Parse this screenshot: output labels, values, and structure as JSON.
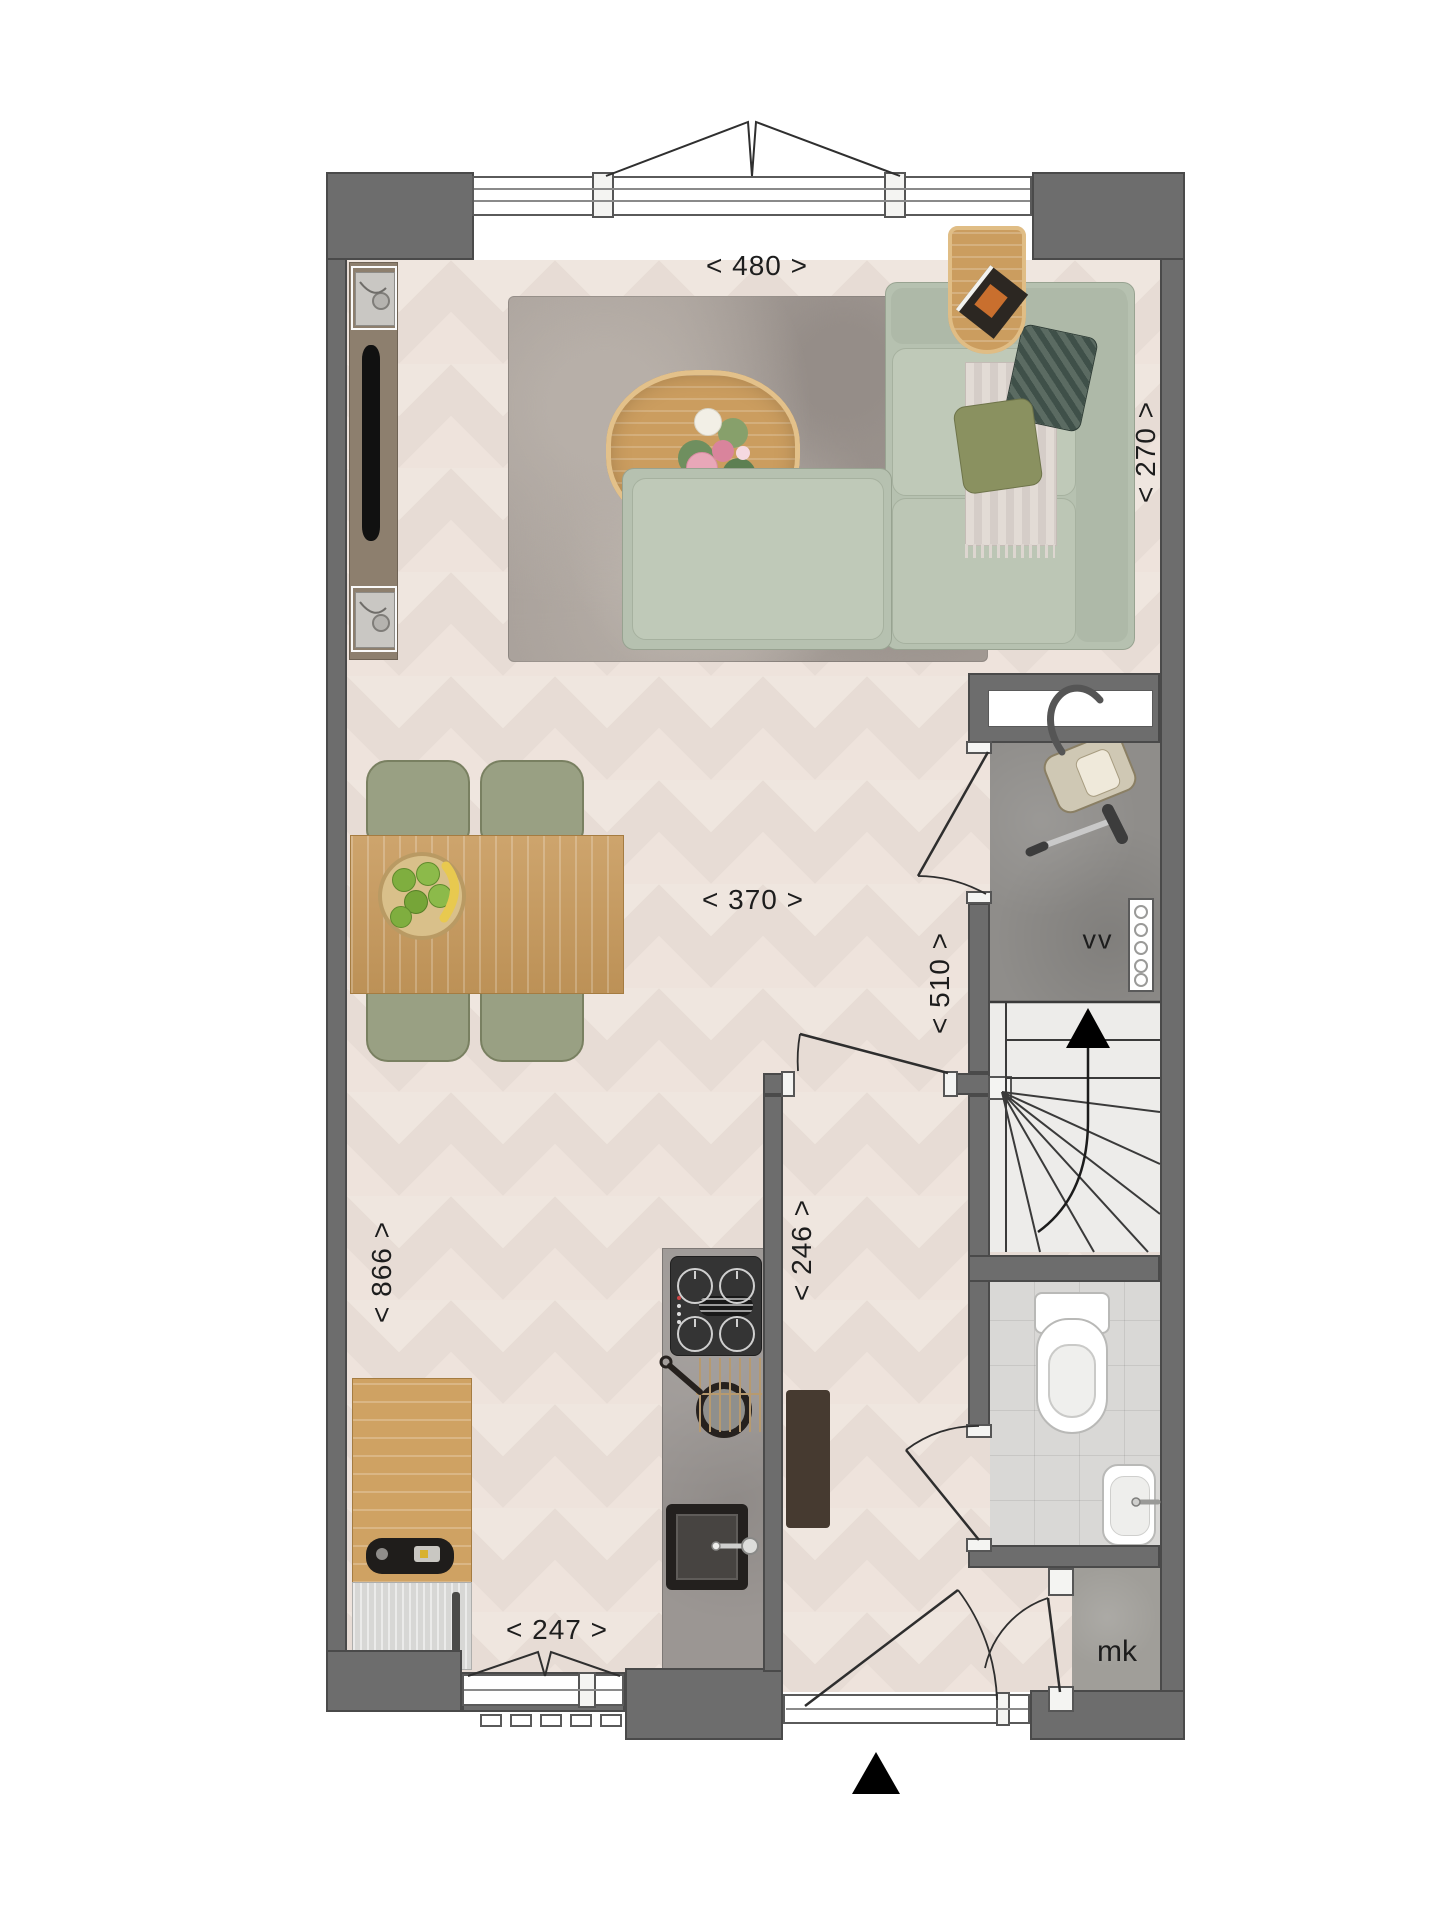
{
  "title": "Ground floor plan",
  "labels": {
    "dim_width_top": "< 480 >",
    "dim_living_depth": "< 270 >",
    "dim_living_width": "< 370 >",
    "dim_hall_depth": "< 510 >",
    "dim_left_depth": "< 866 >",
    "dim_kitchen_depth": "< 246 >",
    "dim_kitchen_width": "< 247 >",
    "room_vv": "vv",
    "room_mk": "mk"
  },
  "colors": {
    "wall": "#6d6d6d",
    "wall_outline": "#4a4a4a",
    "floor": "#e7dcd5",
    "rug": "#a8a09a",
    "sofa": "#b6c1b0",
    "chair": "#99a083",
    "wood": "#c89a5c",
    "counter": "#9b9693",
    "concrete": "#8f8d8a",
    "text": "#1d1d1d"
  }
}
